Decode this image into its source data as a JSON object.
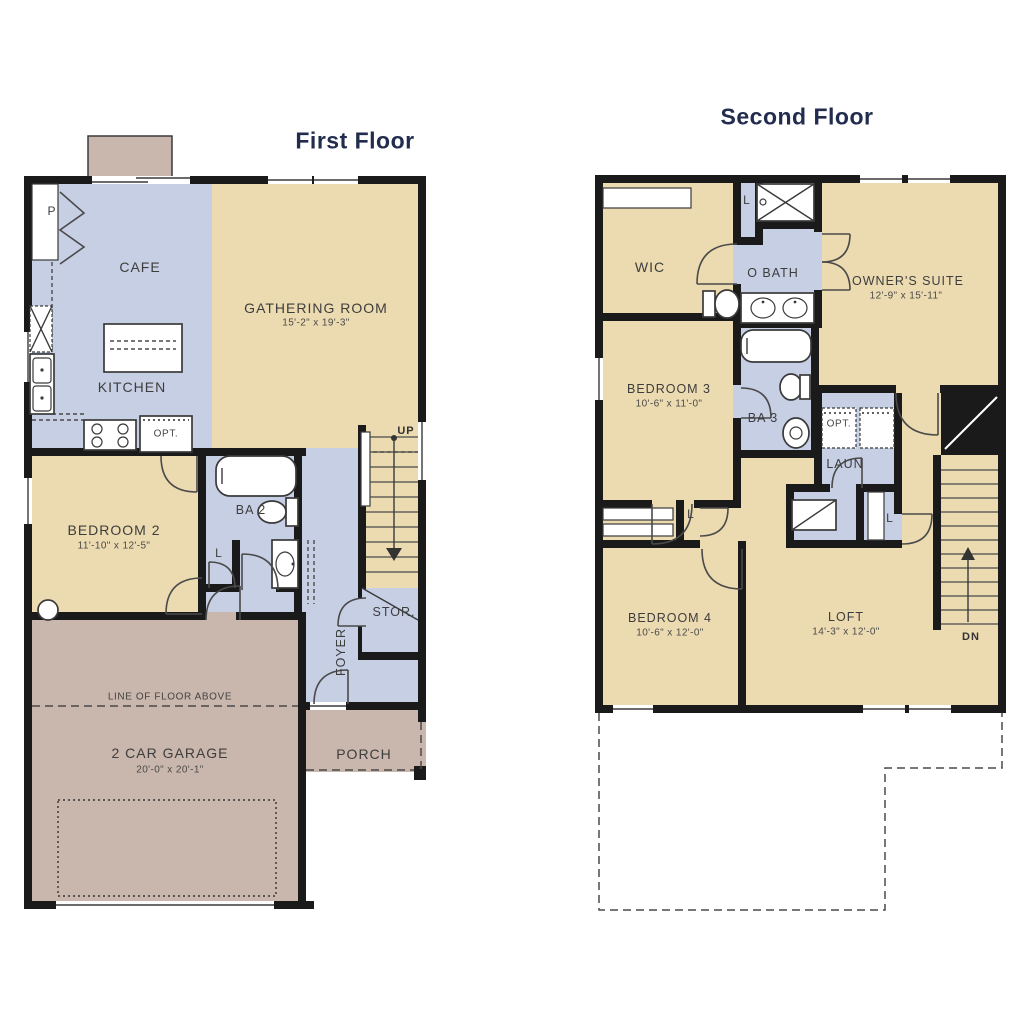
{
  "first_floor": {
    "title": "First Floor",
    "rooms": {
      "cafe": {
        "label": "CAFE"
      },
      "kitchen": {
        "label": "KITCHEN"
      },
      "gathering_room": {
        "label": "GATHERING ROOM",
        "dims": "15'-2\" x 19'-3\""
      },
      "bedroom_2": {
        "label": "BEDROOM 2",
        "dims": "11'-10\" x 12'-5\""
      },
      "bath_2": {
        "label": "BA 2"
      },
      "pantry": {
        "label": "P"
      },
      "linen": {
        "label": "L"
      },
      "storage": {
        "label": "STOR."
      },
      "foyer": {
        "label": "FOYER"
      },
      "garage": {
        "label": "2 CAR GARAGE",
        "dims": "20'-0\" x 20'-1\""
      },
      "porch": {
        "label": "PORCH"
      }
    },
    "annotations": {
      "up": "UP",
      "opt": "OPT.",
      "line_of_floor_above": "LINE OF FLOOR ABOVE"
    }
  },
  "second_floor": {
    "title": "Second Floor",
    "rooms": {
      "wic": {
        "label": "WIC"
      },
      "owners_bath": {
        "label": "O BATH"
      },
      "owners_suite": {
        "label": "OWNER'S SUITE",
        "dims": "12'-9\" x 15'-11\""
      },
      "bedroom_3": {
        "label": "BEDROOM 3",
        "dims": "10'-6\" x 11'-0\""
      },
      "bath_3": {
        "label": "BA 3"
      },
      "laundry": {
        "label": "LAUN"
      },
      "bedroom_4": {
        "label": "BEDROOM 4",
        "dims": "10'-6\" x 12'-0\""
      },
      "loft": {
        "label": "LOFT",
        "dims": "14'-3\" x 12'-0\""
      },
      "linen_top": {
        "label": "L"
      },
      "linen_hall": {
        "label": "L"
      },
      "linen_loft": {
        "label": "L"
      }
    },
    "annotations": {
      "dn": "DN",
      "opt": "OPT."
    }
  },
  "colors": {
    "wall": "#1a1a1a",
    "room_tan": "#ecdbb1",
    "room_blue": "#c7cfe4",
    "room_mauve": "#c9b6ac",
    "title_text": "#222c4e",
    "label_text": "#3d3d3d"
  }
}
